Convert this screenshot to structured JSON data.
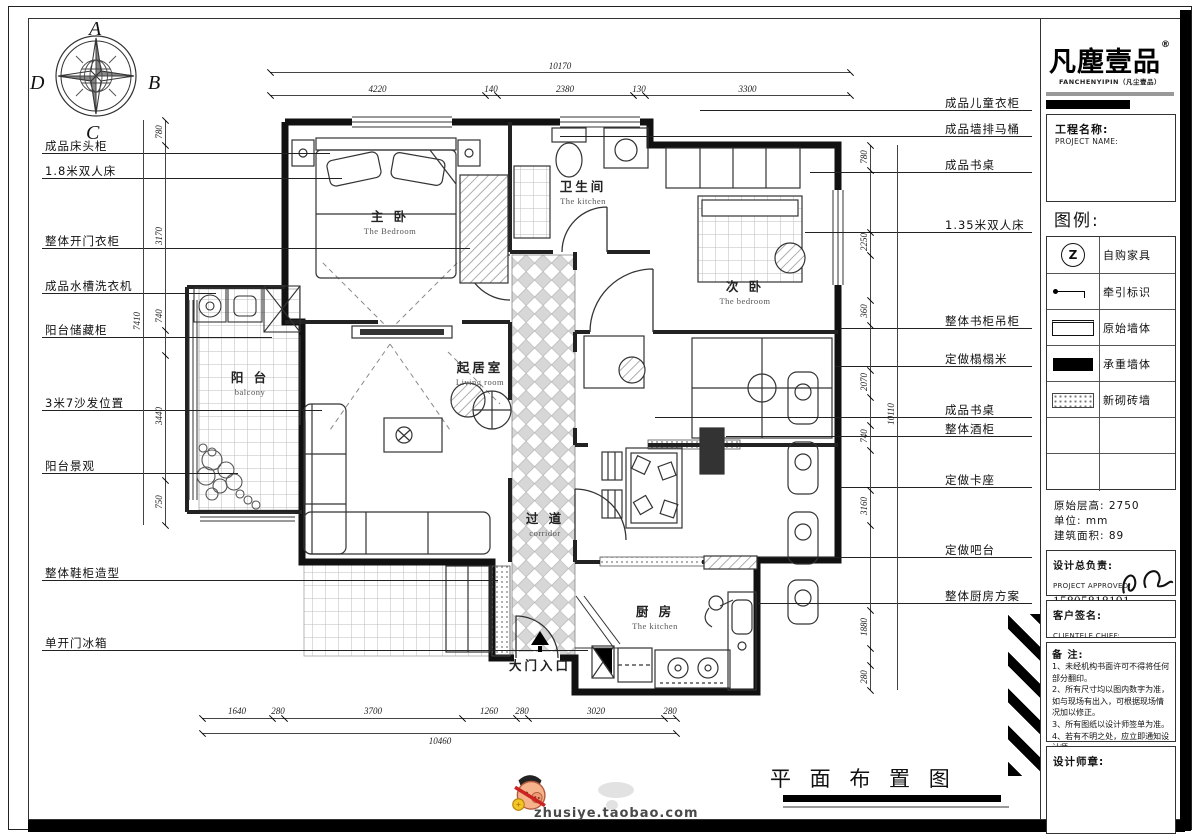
{
  "compass": {
    "n": "A",
    "e": "B",
    "s": "C",
    "w": "D"
  },
  "plan": {
    "left_callouts": [
      "成品床头柜",
      "1.8米双人床",
      "整体开门衣柜",
      "成品水槽洗衣机",
      "阳台储藏柜",
      "3米7沙发位置",
      "阳台景观",
      "整体鞋柜造型",
      "单开门冰箱"
    ],
    "right_callouts": [
      "成品儿童衣柜",
      "成品墙排马桶",
      "成品书桌",
      "1.35米双人床",
      "整体书柜吊柜",
      "定做榻榻米",
      "成品书桌",
      "整体酒柜",
      "定做卡座",
      "定做吧台",
      "整体厨房方案"
    ],
    "rooms": [
      {
        "zh": "主 卧",
        "en": "The Bedroom"
      },
      {
        "zh": "卫生间",
        "en": "The kitchen"
      },
      {
        "zh": "次 卧",
        "en": "The bedroom"
      },
      {
        "zh": "起居室",
        "en": "Living room"
      },
      {
        "zh": "阳 台",
        "en": "balcony"
      },
      {
        "zh": "过 道",
        "en": "corridor"
      },
      {
        "zh": "厨 房",
        "en": "The kitchen"
      },
      {
        "zh": "大门入口",
        "en": ""
      }
    ],
    "dims": {
      "top_total": "10170",
      "top_segments": [
        "4220",
        "140",
        "2380",
        "130",
        "3300"
      ],
      "bottom_segments": [
        "1640",
        "280",
        "3700",
        "1260",
        "280",
        "3020",
        "280"
      ],
      "bottom_total": "10460",
      "left_segments": [
        "780",
        "3170",
        "740",
        "3440",
        "750"
      ],
      "left_total": "7410",
      "right_segments": [
        "780",
        "2250",
        "360",
        "2070",
        "740",
        "3160",
        "1880",
        "280"
      ],
      "right_total": "10110"
    }
  },
  "title_block": {
    "logo": {
      "name": "凡塵壹品",
      "reg": "®",
      "sub": "FANCHENYIPIN（凡尘壹品）"
    },
    "project": {
      "label": "工程名称:",
      "label_en": "PROJECT NAME:"
    },
    "legend": {
      "title": "图例:",
      "items": [
        {
          "symbol": "Z",
          "label": "自购家具"
        },
        {
          "label": "牵引标识"
        },
        {
          "label": "原始墙体"
        },
        {
          "label": "承重墙体"
        },
        {
          "label": "新砌砖墙"
        }
      ]
    },
    "info": [
      "原始层高: 2750",
      "单位: mm",
      "建筑面积: 89"
    ],
    "approver": {
      "label": "设计总负责:",
      "label_en": "PROJECT APPROVED:",
      "phone": "15805818191"
    },
    "client": {
      "label": "客户签名:",
      "label_en": "CLIENTELE CHIEF:"
    },
    "notes_title": "备  注:",
    "notes": [
      "1、未经机构书面许可不得将任何部分翻印。",
      "2、所有尺寸均以图内数字为准，如与现场有出入，可根据现场情况加以修正。",
      "3、所有图纸以设计师签单为准。",
      "4、若有不明之处，应立即通知设计师。"
    ],
    "stamp_label": "设计师章:"
  },
  "sheet_title": "平 面 布 置 图",
  "watermark": {
    "site": "zhusiye.taobao.com"
  }
}
